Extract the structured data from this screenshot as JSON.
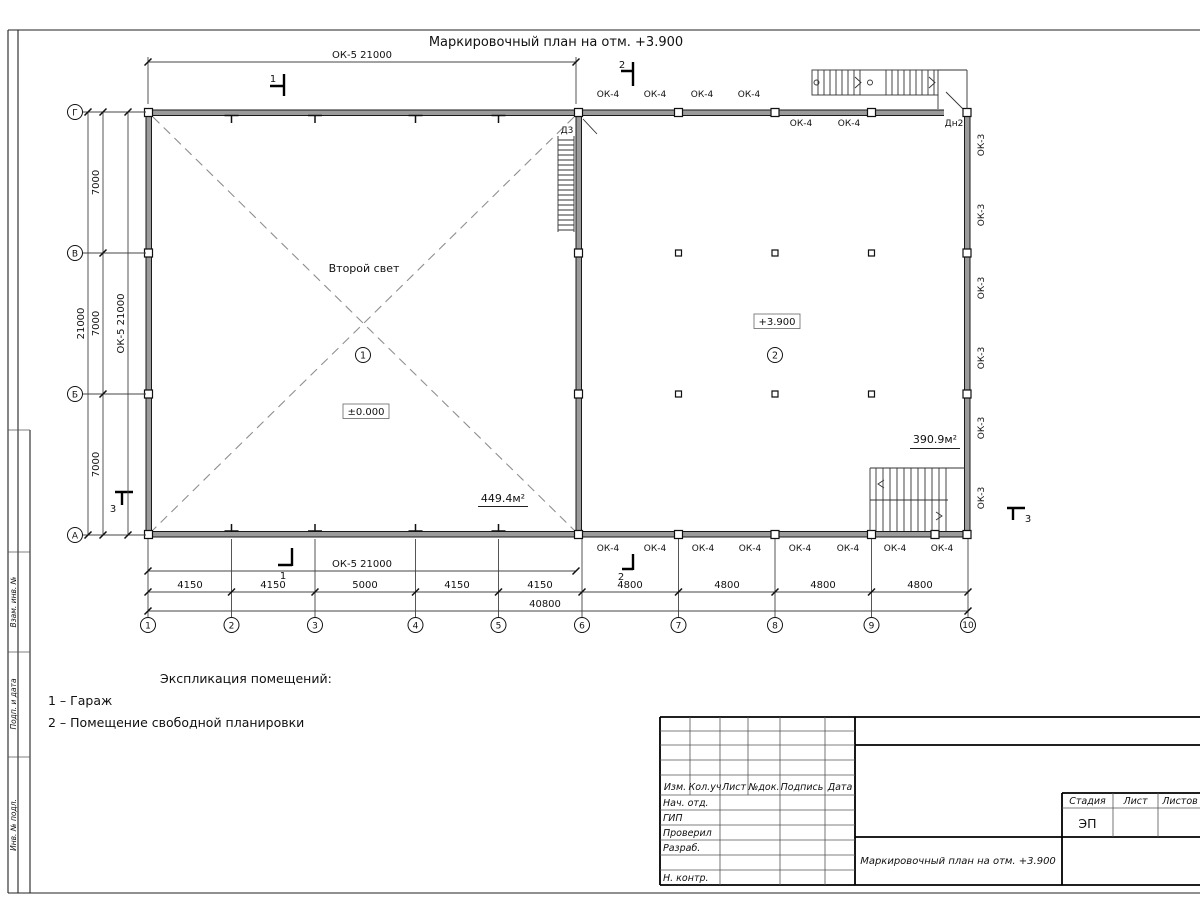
{
  "title": "Маркировочный план на отм. +3.900",
  "labels": {
    "ok4": "ОК-4",
    "ok3": "ОК-3",
    "ok5_21000": "ОК-5 21000",
    "d3": "Д3",
    "dn2": "Дн2",
    "second_light": "Второй свет",
    "level_zero": "±0.000",
    "level_high": "+3.900",
    "area_garage": "449.4м²",
    "area_free": "390.9м²",
    "room1": "1",
    "room2": "2",
    "section1": "1",
    "section2": "2",
    "section3": "3"
  },
  "axes": {
    "vertical": [
      "Г",
      "В",
      "Б",
      "А"
    ],
    "horizontal": [
      "1",
      "2",
      "3",
      "4",
      "5",
      "6",
      "7",
      "8",
      "9",
      "10"
    ]
  },
  "dimensions": {
    "left_spans": [
      "7000",
      "7000",
      "7000"
    ],
    "left_total": "21000",
    "bottom_spans": [
      "4150",
      "4150",
      "5000",
      "4150",
      "4150",
      "4800",
      "4800",
      "4800",
      "4800"
    ],
    "bottom_total": "40800"
  },
  "legend": {
    "title": "Экспликация помещений:",
    "items": [
      "1 – Гараж",
      "2 – Помещение свободной планировки"
    ]
  },
  "title_block": {
    "columns": [
      "Изм.",
      "Кол.уч",
      "Лист",
      "№док.",
      "Подпись",
      "Дата"
    ],
    "rows": [
      "Нач. отд.",
      "ГИП",
      "Проверил",
      "Разраб.",
      "Н. контр."
    ],
    "stage_label": "Стадия",
    "sheet_label": "Лист",
    "sheets_label": "Листов",
    "stage_value": "ЭП",
    "doc_name": "Маркировочный план на отм. +3.900"
  },
  "margin_stamp": [
    "Взам. инв. №",
    "Подп. и дата",
    "Инв. № подл."
  ]
}
